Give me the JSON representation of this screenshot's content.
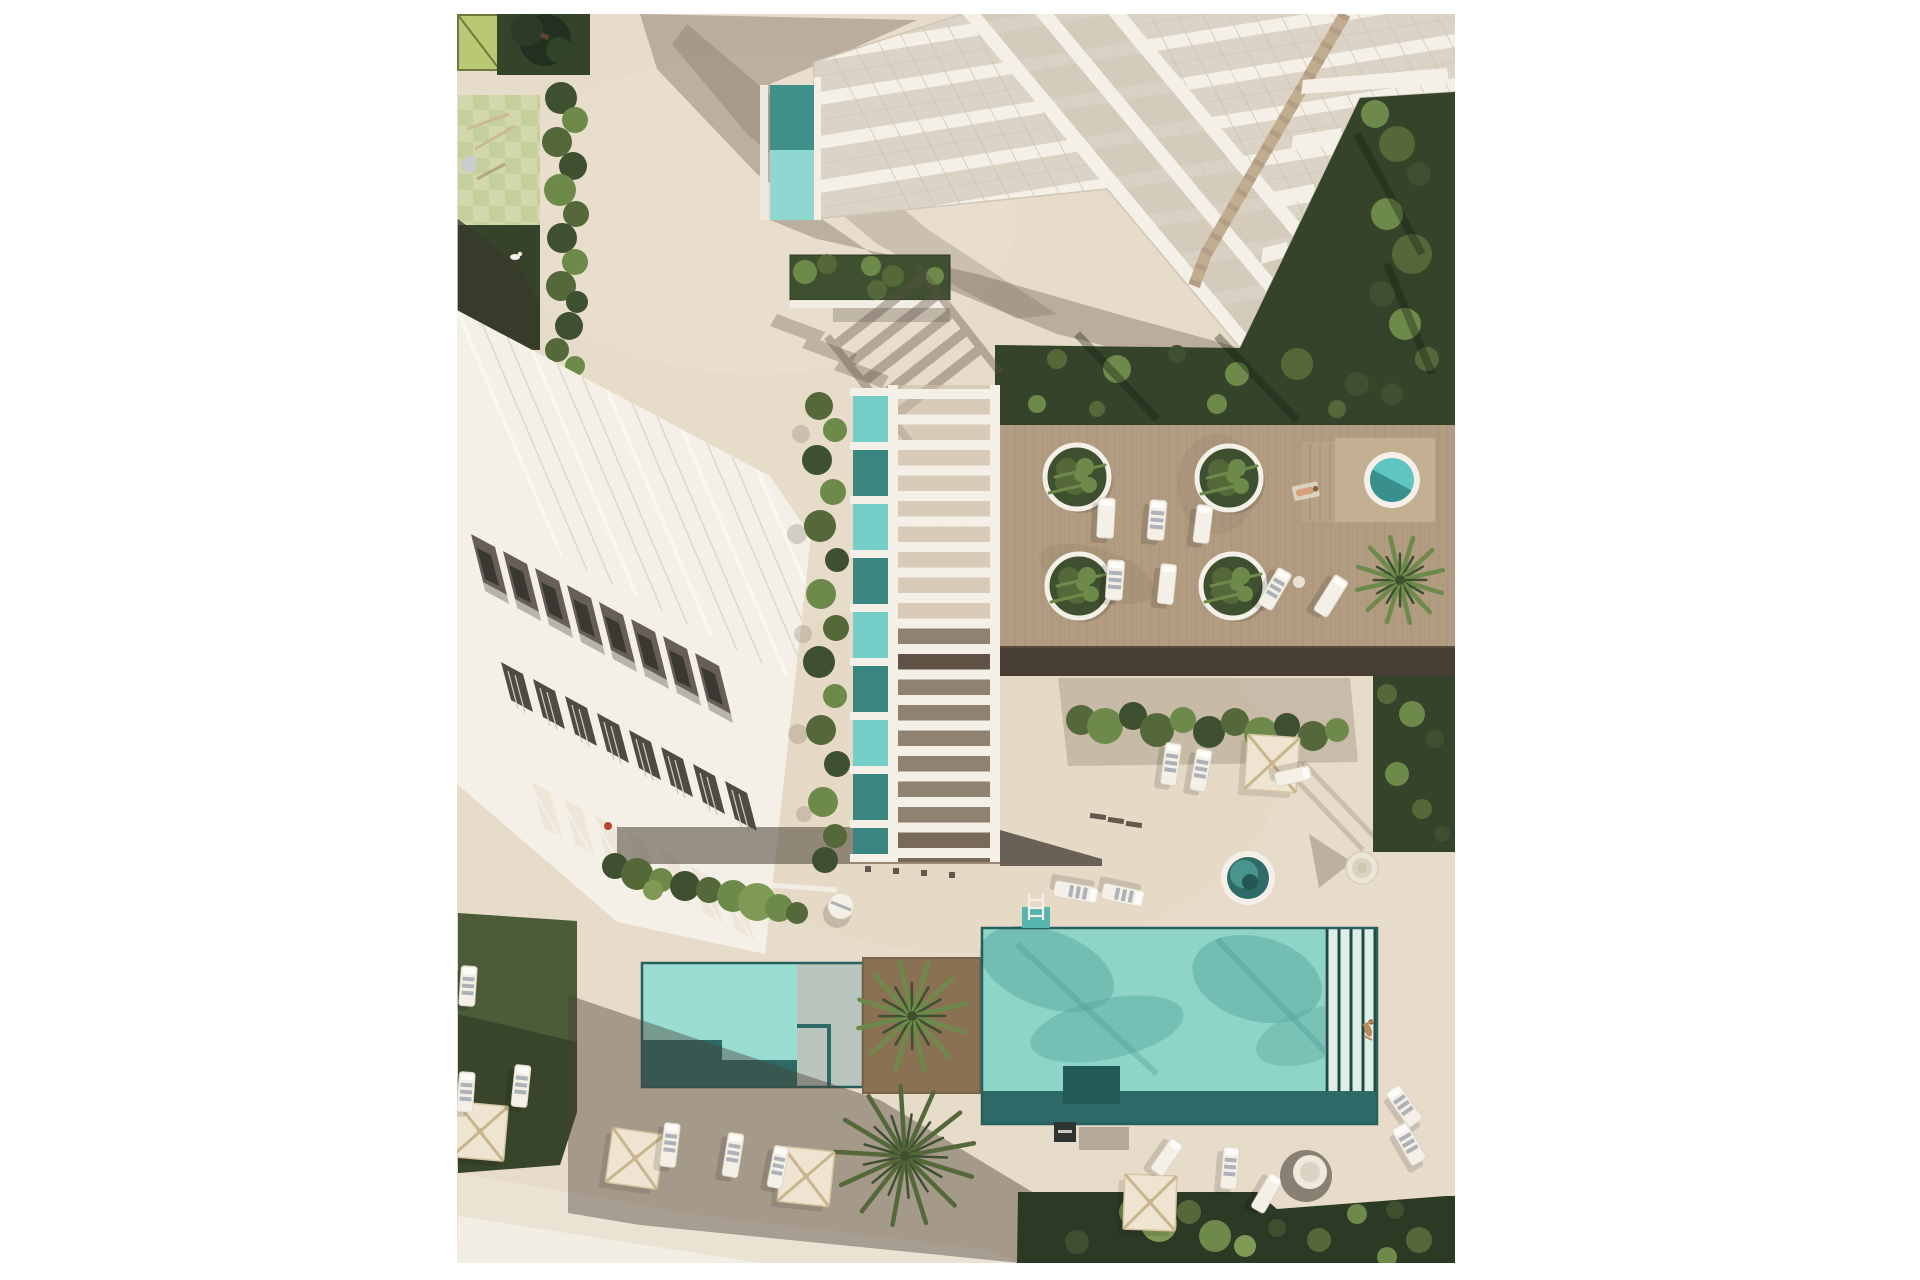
{
  "meta": {
    "description": "Top-down aerial 3D architectural rendering of a white residential resort complex: a terraced tower at top, a row-house building at left, a slatted pergola over a lap pool in the center, a timber sun deck with round planters and two circular spas, a large turquoise swimming pool with lap lanes and a swimmer, a smaller pool, lawns, palm trees, cream sun umbrellas and loungers, all on beige paving with long afternoon shadows."
  },
  "palette": {
    "pavement": "#e7dbc9",
    "pavement-grid": "#d8ccb8",
    "path-light": "#eae3d4",
    "path-bright": "#f2eee4",
    "white-s": "#f4f0e8",
    "glass": "#dbd3c5",
    "glass-dark": "#d2c9ba",
    "tan-wood": "#c2ac8f",
    "wood": "#b29c81",
    "wood-light": "#c4af93",
    "espresso": "#473d33",
    "grass-dark": "#36432b",
    "grass-mid": "#4c5c39",
    "leaf0": "#55683a",
    "leaf1": "#6d8a4a",
    "leaf2": "#3e5030",
    "leaf3": "#7f9a55",
    "pool-light": "#8ed5c8",
    "pool-dark": "#2d6966",
    "pool-teal": "#3c8682",
    "pool-pale": "#9addd2",
    "cream": "#eee4d1",
    "umb-frame": "#c9b68f",
    "bay": "#675f55",
    "win": "#3a3832",
    "shadow-brown": "#5e5043",
    "skin": "#d8a07a",
    "pg-light": "#d2d8ac",
    "pg-dark": "#c5cf9c",
    "lime": "#b9c873"
  },
  "scene": {
    "canvas": {
      "left": 457,
      "top": 14,
      "width": 998,
      "height": 1249
    },
    "pergola": {
      "x": 431,
      "y": 371,
      "w": 112,
      "h": 477,
      "rungs": 19,
      "rail_w": 10,
      "rung_h": 10
    },
    "deck_planters": [
      [
        620,
        463
      ],
      [
        772,
        464
      ],
      [
        622,
        572
      ],
      [
        776,
        572
      ]
    ],
    "planter_leaf_offsets": [
      [
        -10,
        -8,
        11
      ],
      [
        8,
        -10,
        9
      ],
      [
        -2,
        6,
        12
      ],
      [
        12,
        8,
        8
      ],
      [
        -14,
        6,
        8
      ],
      [
        4,
        -2,
        7
      ]
    ],
    "umbrellas": [
      [
        23,
        1117,
        5
      ],
      [
        178,
        1144,
        8
      ],
      [
        349,
        1162,
        6
      ],
      [
        693,
        1188,
        2
      ],
      [
        815,
        749,
        4
      ]
    ],
    "loungers": [
      [
        11,
        972,
        4,
        16,
        40,
        1
      ],
      [
        9,
        1078,
        4,
        16,
        40,
        1
      ],
      [
        64,
        1072,
        6,
        16,
        42,
        1
      ],
      [
        213,
        1131,
        7,
        16,
        44,
        1
      ],
      [
        276,
        1141,
        9,
        16,
        44,
        1
      ],
      [
        321,
        1153,
        11,
        15,
        42,
        1
      ],
      [
        649,
        504,
        3,
        17,
        40,
        0
      ],
      [
        700,
        506,
        5,
        17,
        40,
        1
      ],
      [
        746,
        510,
        7,
        16,
        38,
        0
      ],
      [
        658,
        566,
        4,
        17,
        40,
        1
      ],
      [
        710,
        570,
        6,
        16,
        40,
        0
      ],
      [
        818,
        575,
        30,
        16,
        42,
        1
      ],
      [
        874,
        582,
        32,
        16,
        42,
        0
      ],
      [
        714,
        750,
        8,
        16,
        42,
        1
      ],
      [
        744,
        756,
        10,
        16,
        42,
        1
      ],
      [
        836,
        762,
        78,
        14,
        36,
        0
      ],
      [
        619,
        878,
        100,
        16,
        44,
        1
      ],
      [
        666,
        881,
        102,
        16,
        42,
        1
      ],
      [
        710,
        1143,
        35,
        15,
        38,
        0
      ],
      [
        773,
        1154,
        5,
        16,
        42,
        1
      ],
      [
        810,
        1179,
        30,
        15,
        40,
        0
      ],
      [
        947,
        1092,
        -35,
        17,
        42,
        1
      ],
      [
        952,
        1130,
        -30,
        17,
        42,
        1
      ]
    ],
    "palms": [
      [
        943,
        566,
        44,
        12,
        1
      ],
      [
        455,
        1002,
        55,
        12,
        1
      ],
      [
        448,
        1142,
        70,
        13,
        0
      ]
    ],
    "hedge_col": [
      [
        104,
        84,
        16,
        2
      ],
      [
        118,
        106,
        13,
        1
      ],
      [
        100,
        128,
        15,
        0
      ],
      [
        116,
        152,
        14,
        2
      ],
      [
        103,
        176,
        16,
        1
      ],
      [
        119,
        200,
        13,
        0
      ],
      [
        105,
        224,
        15,
        2
      ],
      [
        118,
        248,
        13,
        1
      ],
      [
        104,
        272,
        15,
        0
      ],
      [
        120,
        288,
        11,
        2
      ],
      [
        112,
        312,
        14,
        2
      ],
      [
        100,
        336,
        12,
        0
      ],
      [
        118,
        352,
        10,
        1
      ]
    ],
    "planting_strip": [
      [
        362,
        392,
        14,
        0
      ],
      [
        378,
        416,
        12,
        1
      ],
      [
        360,
        446,
        15,
        2
      ],
      [
        376,
        478,
        13,
        1
      ],
      [
        363,
        512,
        16,
        0
      ],
      [
        380,
        546,
        12,
        2
      ],
      [
        364,
        580,
        15,
        1
      ],
      [
        379,
        614,
        13,
        0
      ],
      [
        362,
        648,
        16,
        2
      ],
      [
        378,
        682,
        12,
        1
      ],
      [
        364,
        716,
        15,
        0
      ],
      [
        380,
        750,
        13,
        2
      ],
      [
        366,
        788,
        15,
        1
      ],
      [
        378,
        822,
        12,
        0
      ],
      [
        368,
        846,
        13,
        2
      ]
    ],
    "strip_shadow": [
      [
        344,
        420,
        9
      ],
      [
        340,
        520,
        10
      ],
      [
        346,
        620,
        9
      ],
      [
        341,
        720,
        10
      ],
      [
        347,
        800,
        8
      ]
    ],
    "hedge_mid": [
      [
        624,
        706,
        15,
        0
      ],
      [
        648,
        712,
        18,
        1
      ],
      [
        676,
        702,
        14,
        2
      ],
      [
        700,
        716,
        17,
        0
      ],
      [
        726,
        706,
        13,
        1
      ],
      [
        752,
        718,
        16,
        2
      ],
      [
        778,
        708,
        14,
        0
      ],
      [
        804,
        720,
        17,
        1
      ],
      [
        830,
        712,
        13,
        2
      ],
      [
        856,
        722,
        15,
        0
      ],
      [
        880,
        716,
        12,
        1
      ]
    ],
    "bushes_strip": [
      [
        158,
        852,
        13,
        2
      ],
      [
        180,
        860,
        16,
        0
      ],
      [
        204,
        866,
        12,
        1
      ],
      [
        228,
        872,
        15,
        2
      ],
      [
        252,
        876,
        13,
        0
      ],
      [
        276,
        882,
        16,
        1
      ],
      [
        300,
        888,
        19,
        3
      ],
      [
        322,
        894,
        14,
        1
      ],
      [
        340,
        899,
        11,
        0
      ],
      [
        196,
        876,
        10,
        3
      ]
    ],
    "garden_leaves": [
      [
        918,
        100,
        14,
        1
      ],
      [
        940,
        130,
        18,
        0
      ],
      [
        962,
        160,
        12,
        2
      ],
      [
        930,
        200,
        16,
        1
      ],
      [
        955,
        240,
        20,
        0
      ],
      [
        925,
        280,
        13,
        2
      ],
      [
        948,
        310,
        16,
        1
      ],
      [
        970,
        345,
        12,
        0
      ],
      [
        600,
        345,
        10,
        0
      ],
      [
        660,
        355,
        14,
        1
      ],
      [
        720,
        340,
        9,
        2
      ],
      [
        780,
        360,
        12,
        1
      ],
      [
        840,
        350,
        16,
        0
      ],
      [
        900,
        370,
        12,
        2
      ],
      [
        580,
        390,
        9,
        1
      ],
      [
        640,
        395,
        8,
        0
      ],
      [
        760,
        390,
        10,
        1
      ],
      [
        880,
        395,
        9,
        0
      ],
      [
        935,
        380,
        11,
        2
      ]
    ],
    "rightstrip_leaves": [
      [
        930,
        680,
        10,
        0
      ],
      [
        955,
        700,
        13,
        1
      ],
      [
        978,
        725,
        9,
        2
      ],
      [
        940,
        760,
        12,
        1
      ],
      [
        965,
        795,
        10,
        0
      ],
      [
        985,
        820,
        8,
        2
      ]
    ],
    "bottom_right_leaves": [
      [
        676,
        1198,
        14,
        1
      ],
      [
        702,
        1210,
        18,
        3
      ],
      [
        732,
        1198,
        12,
        0
      ],
      [
        758,
        1222,
        16,
        1
      ],
      [
        788,
        1232,
        11,
        3
      ],
      [
        820,
        1214,
        9,
        2
      ],
      [
        862,
        1226,
        12,
        0
      ],
      [
        900,
        1200,
        10,
        1
      ],
      [
        938,
        1196,
        9,
        2
      ],
      [
        962,
        1226,
        13,
        0
      ],
      [
        930,
        1243,
        10,
        1
      ],
      [
        620,
        1228,
        12,
        2
      ]
    ],
    "tip_planter_leaves": [
      [
        348,
        258,
        12,
        1
      ],
      [
        370,
        250,
        10,
        0
      ],
      [
        392,
        262,
        13,
        2
      ],
      [
        414,
        252,
        10,
        1
      ],
      [
        436,
        262,
        11,
        0
      ],
      [
        458,
        252,
        10,
        2
      ],
      [
        478,
        262,
        9,
        1
      ],
      [
        360,
        276,
        9,
        2
      ],
      [
        420,
        276,
        10,
        0
      ],
      [
        466,
        274,
        8,
        2
      ]
    ]
  }
}
